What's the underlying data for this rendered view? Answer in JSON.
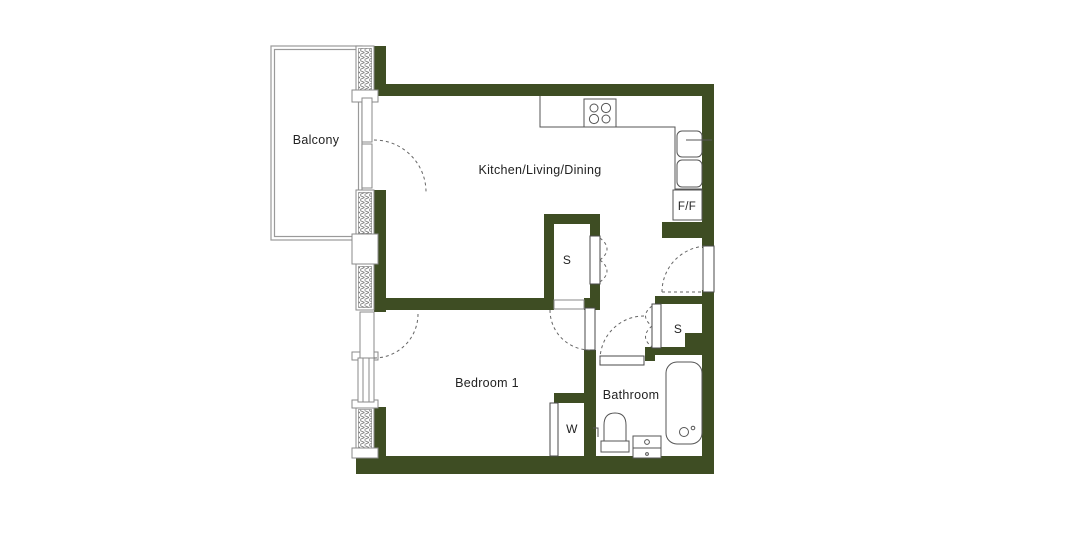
{
  "floor_plan": {
    "rooms": {
      "balcony": {
        "label": "Balcony"
      },
      "kitchen_living_dining": {
        "label": "Kitchen/Living/Dining"
      },
      "bedroom_1": {
        "label": "Bedroom 1"
      },
      "bathroom": {
        "label": "Bathroom"
      }
    },
    "features": {
      "storage_hall": {
        "label": "S"
      },
      "storage_entry": {
        "label": "S"
      },
      "wardrobe": {
        "label": "W"
      },
      "fridge_freezer": {
        "label": "F/F"
      }
    },
    "fixtures": [
      "hob-4-ring-icon",
      "kitchen-sink-icon",
      "bathtub-icon",
      "toilet-icon",
      "basin-icon"
    ],
    "colors": {
      "wall": "#3e4d23",
      "line": "#555555",
      "frame": "#8a8a8a",
      "text": "#222222",
      "background": "#ffffff"
    }
  }
}
